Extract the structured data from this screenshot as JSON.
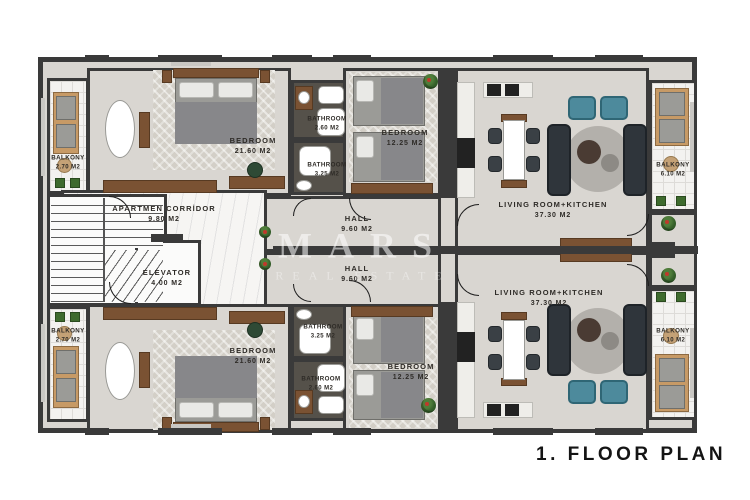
{
  "title": "1. FLOOR PLAN",
  "watermark": {
    "brand": "MARS",
    "sub": "REAL ESTATE"
  },
  "colors": {
    "wall": "#3a3a3a",
    "floor": "#d9d6d1",
    "balcony_tile": "#f3f2f0",
    "bathroom_floor": "#55514a",
    "accent_teal": "#4d8a9c",
    "wood": "#7a5233"
  },
  "units": {
    "corridor": {
      "label": "APARTMEN CORRİDOR",
      "area": "9.80 m2"
    },
    "elevator": {
      "label": "ELEVATOR",
      "area": "4.00 m2"
    },
    "hall_top": {
      "label": "HALL",
      "area": "9.60 m2"
    },
    "hall_bottom": {
      "label": "HALL",
      "area": "9.60 m2"
    },
    "bedroom_master_top": {
      "label": "BEDROOM",
      "area": "21.60 m2"
    },
    "bedroom_master_bottom": {
      "label": "BEDROOM",
      "area": "21.60 m2"
    },
    "bedroom_small_top": {
      "label": "BEDROOM",
      "area": "12.25 m2"
    },
    "bedroom_small_bottom": {
      "label": "BEDROOM",
      "area": "12.25 m2"
    },
    "bathroom_small_top": {
      "label": "BATHROOM",
      "area": "2.60 m2"
    },
    "bathroom_large_top": {
      "label": "BATHROOM",
      "area": "3.25 m2"
    },
    "bathroom_large_bottom": {
      "label": "BATHROOM",
      "area": "3.25 m2"
    },
    "bathroom_small_bottom": {
      "label": "BATHROOM",
      "area": "2.60 m2"
    },
    "living_top": {
      "label": "LIVING ROOM+KITCHEN",
      "area": "37.30 m2"
    },
    "living_bottom": {
      "label": "LIVING ROOM+KITCHEN",
      "area": "37.30 m2"
    },
    "balcony_left_top": {
      "label": "BALKONY",
      "area": "2.70 m2"
    },
    "balcony_left_bottom": {
      "label": "BALKONY",
      "area": "2.70 m2"
    },
    "balcony_right_top": {
      "label": "BALKONY",
      "area": "6.10 m2"
    },
    "balcony_right_bottom": {
      "label": "BALKONY",
      "area": "6.10 m2"
    }
  }
}
